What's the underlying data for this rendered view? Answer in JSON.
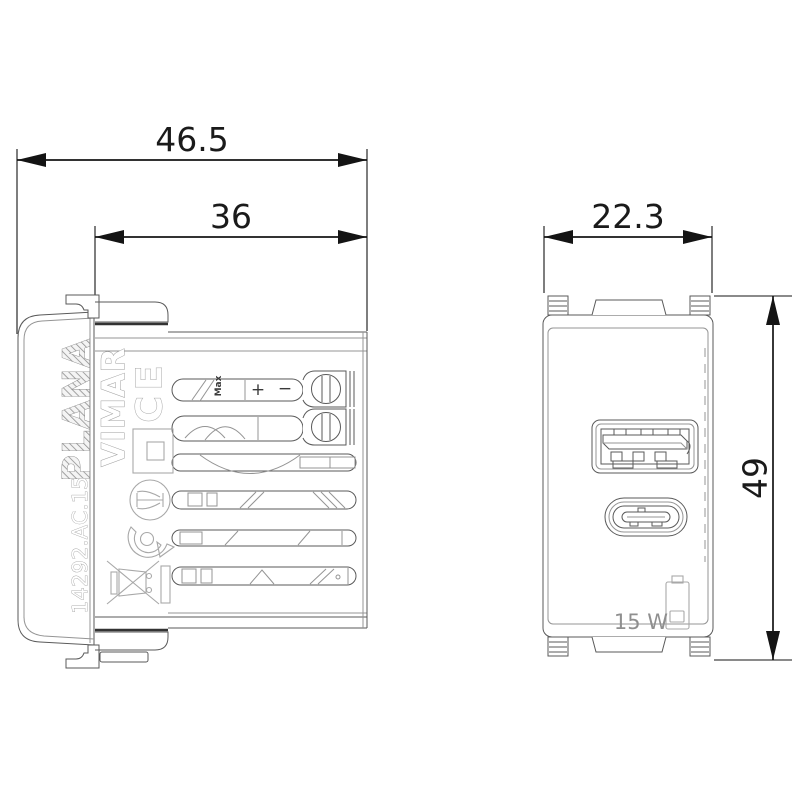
{
  "colors": {
    "background": "#ffffff",
    "drawing_line": "#5a5a5a",
    "dimension_line": "#141414",
    "embossed_line": "#a8a8a8",
    "muted_text": "#8f8f8f"
  },
  "dimensions": {
    "total_depth_mm": "46.5",
    "recess_depth_mm": "36",
    "front_width_mm": "22.3",
    "front_height_mm": "49"
  },
  "side_view": {
    "series_label": "PLANA",
    "brand_label": "VIMAR",
    "ce_mark": "CE",
    "part_number": "14292.AC.15",
    "max_label": "Max",
    "plus_label": "+",
    "minus_label": "−"
  },
  "front_view": {
    "power_rating": "15 W"
  },
  "icons": {
    "usb-a-port-icon": "rounded rectangle receptacle with contact tongue",
    "usb-c-port-icon": "stadium-shaped receptacle with center tongue",
    "battery-icon": "battery outline with charge bar",
    "weee-bin-icon": "crossed-out wheelie bin (rotated)",
    "ce-mark": "CE conformity letters (rotated)",
    "double-insulation-icon": "square inside square",
    "certification-circle-icon": "circle with trident mark",
    "recycling-mark-icon": "circular arrow around dot",
    "terminal-screw-icon": "slotted screw head",
    "mounting-claw-icon": "hook shaped claw"
  }
}
